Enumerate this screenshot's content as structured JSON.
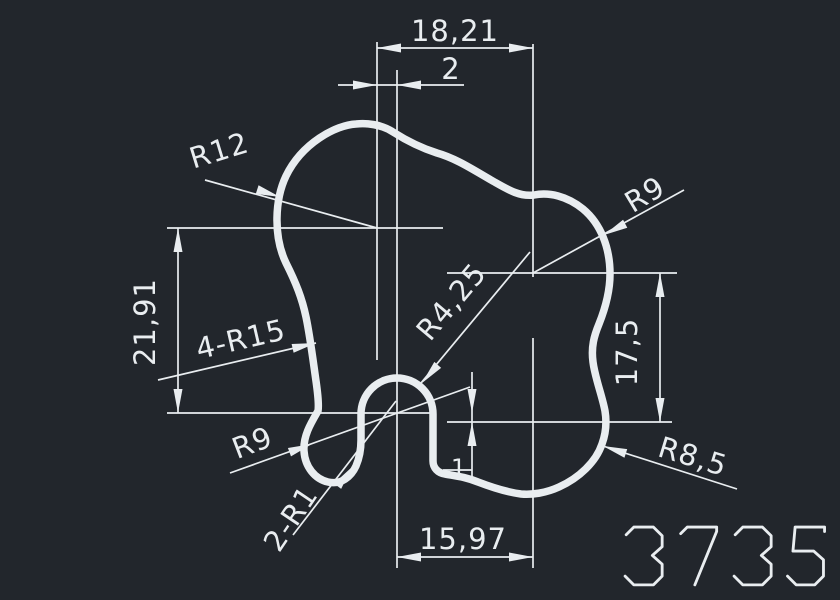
{
  "drawing": {
    "background_color": "#22262c",
    "line_color": "#e9edf0",
    "part_number": "3735",
    "dimensions": {
      "width_total": "18,21",
      "offset_top": "2",
      "height_left": "21,91",
      "height_right": "17,5",
      "width_bottom": "15,97",
      "offset_bottom": "1"
    },
    "radii": {
      "top_left": "R12",
      "top_right": "R9",
      "left_sides": "4-R15",
      "center_slot": "R4,25",
      "bottom_left_lobe": "R9",
      "bottom_corners": "2-R1",
      "bottom_right": "R8,5"
    }
  }
}
